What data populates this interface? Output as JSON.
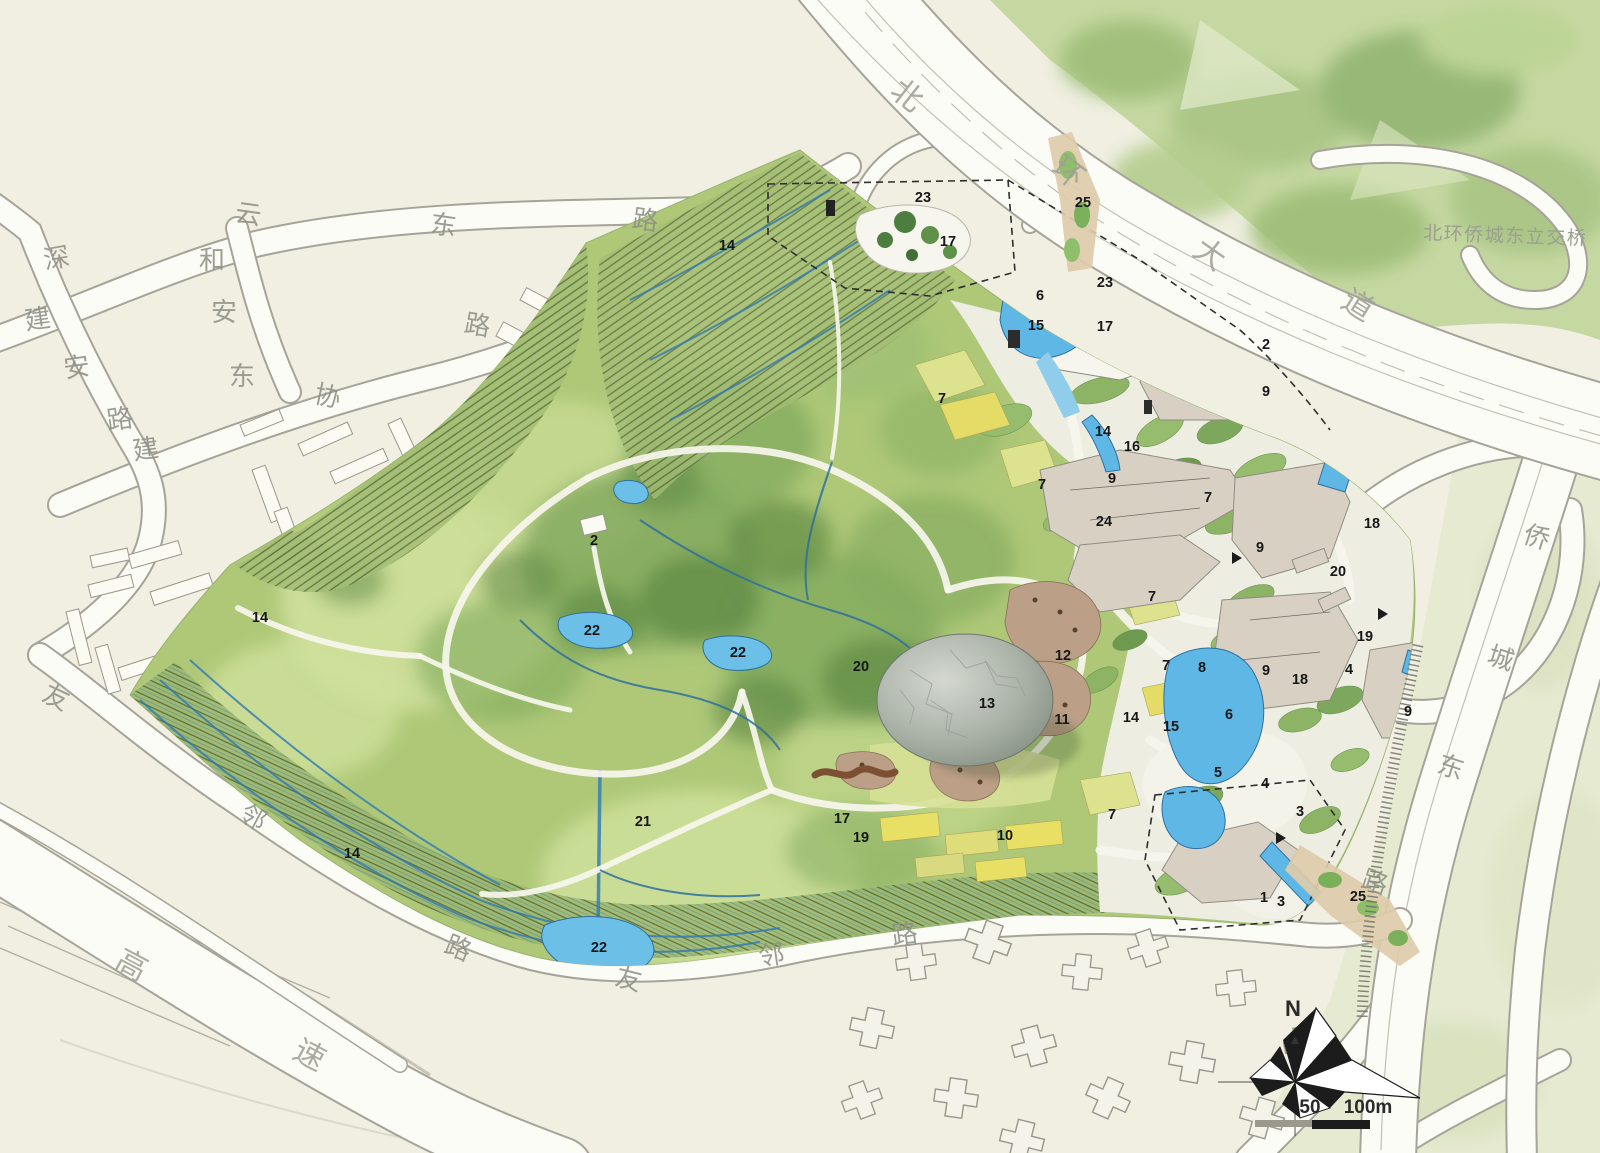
{
  "map": {
    "region_labels": [
      {
        "n": "14",
        "x": 727,
        "y": 246
      },
      {
        "n": "23",
        "x": 923,
        "y": 198
      },
      {
        "n": "17",
        "x": 948,
        "y": 242
      },
      {
        "n": "25",
        "x": 1083,
        "y": 203
      },
      {
        "n": "23",
        "x": 1105,
        "y": 283
      },
      {
        "n": "6",
        "x": 1040,
        "y": 296
      },
      {
        "n": "15",
        "x": 1036,
        "y": 326
      },
      {
        "n": "17",
        "x": 1105,
        "y": 327
      },
      {
        "n": "2",
        "x": 1266,
        "y": 345
      },
      {
        "n": "9",
        "x": 1266,
        "y": 392
      },
      {
        "n": "7",
        "x": 942,
        "y": 399
      },
      {
        "n": "14",
        "x": 1103,
        "y": 432
      },
      {
        "n": "16",
        "x": 1132,
        "y": 447
      },
      {
        "n": "9",
        "x": 1112,
        "y": 479
      },
      {
        "n": "7",
        "x": 1042,
        "y": 485
      },
      {
        "n": "7",
        "x": 1208,
        "y": 498
      },
      {
        "n": "24",
        "x": 1104,
        "y": 522
      },
      {
        "n": "2",
        "x": 594,
        "y": 541
      },
      {
        "n": "18",
        "x": 1372,
        "y": 524
      },
      {
        "n": "9",
        "x": 1260,
        "y": 548
      },
      {
        "n": "20",
        "x": 1338,
        "y": 572
      },
      {
        "n": "7",
        "x": 1152,
        "y": 597
      },
      {
        "n": "14",
        "x": 260,
        "y": 618
      },
      {
        "n": "22",
        "x": 592,
        "y": 631
      },
      {
        "n": "12",
        "x": 1063,
        "y": 656
      },
      {
        "n": "19",
        "x": 1365,
        "y": 637
      },
      {
        "n": "22",
        "x": 738,
        "y": 653
      },
      {
        "n": "20",
        "x": 861,
        "y": 667
      },
      {
        "n": "7",
        "x": 1166,
        "y": 666
      },
      {
        "n": "8",
        "x": 1202,
        "y": 668
      },
      {
        "n": "9",
        "x": 1266,
        "y": 671
      },
      {
        "n": "4",
        "x": 1349,
        "y": 670
      },
      {
        "n": "18",
        "x": 1300,
        "y": 680
      },
      {
        "n": "13",
        "x": 987,
        "y": 704
      },
      {
        "n": "11",
        "x": 1062,
        "y": 720
      },
      {
        "n": "14",
        "x": 1131,
        "y": 718
      },
      {
        "n": "15",
        "x": 1171,
        "y": 727
      },
      {
        "n": "6",
        "x": 1229,
        "y": 715
      },
      {
        "n": "9",
        "x": 1408,
        "y": 712
      },
      {
        "n": "5",
        "x": 1218,
        "y": 773
      },
      {
        "n": "4",
        "x": 1265,
        "y": 784
      },
      {
        "n": "7",
        "x": 1112,
        "y": 815
      },
      {
        "n": "3",
        "x": 1300,
        "y": 812
      },
      {
        "n": "21",
        "x": 643,
        "y": 822
      },
      {
        "n": "17",
        "x": 842,
        "y": 819
      },
      {
        "n": "19",
        "x": 861,
        "y": 838
      },
      {
        "n": "10",
        "x": 1005,
        "y": 836
      },
      {
        "n": "14",
        "x": 352,
        "y": 854
      },
      {
        "n": "1",
        "x": 1264,
        "y": 898
      },
      {
        "n": "3",
        "x": 1281,
        "y": 902
      },
      {
        "n": "25",
        "x": 1358,
        "y": 897
      },
      {
        "n": "22",
        "x": 599,
        "y": 948
      }
    ],
    "road_name_chars": [
      {
        "t": "深",
        "x": 57,
        "y": 261,
        "r": -10
      },
      {
        "t": "云",
        "x": 248,
        "y": 217,
        "r": 8
      },
      {
        "t": "东",
        "x": 443,
        "y": 228,
        "r": 8
      },
      {
        "t": "路",
        "x": 645,
        "y": 223,
        "r": 8
      },
      {
        "t": "和",
        "x": 212,
        "y": 263,
        "r": 0
      },
      {
        "t": "安",
        "x": 224,
        "y": 315,
        "r": 0
      },
      {
        "t": "东",
        "x": 242,
        "y": 379,
        "r": 0
      },
      {
        "t": "路",
        "x": 477,
        "y": 328,
        "r": 10
      },
      {
        "t": "建",
        "x": 38,
        "y": 322,
        "r": -8
      },
      {
        "t": "安",
        "x": 77,
        "y": 370,
        "r": -8
      },
      {
        "t": "路",
        "x": 120,
        "y": 422,
        "r": -8
      },
      {
        "t": "建",
        "x": 146,
        "y": 452,
        "r": -8
      },
      {
        "t": "协",
        "x": 327,
        "y": 399,
        "r": 12
      },
      {
        "t": "北",
        "x": 905,
        "y": 98,
        "r": 38,
        "big": true
      },
      {
        "t": "环",
        "x": 1066,
        "y": 175,
        "r": 38,
        "big": true
      },
      {
        "t": "大",
        "x": 1208,
        "y": 257,
        "r": 35,
        "big": true
      },
      {
        "t": "道",
        "x": 1356,
        "y": 308,
        "r": 32,
        "big": true
      },
      {
        "t": "友",
        "x": 55,
        "y": 700,
        "r": 25
      },
      {
        "t": "邻",
        "x": 252,
        "y": 820,
        "r": 28
      },
      {
        "t": "路",
        "x": 457,
        "y": 951,
        "r": 22
      },
      {
        "t": "友",
        "x": 628,
        "y": 982,
        "r": 14
      },
      {
        "t": "邻",
        "x": 772,
        "y": 958,
        "r": -8
      },
      {
        "t": "路",
        "x": 905,
        "y": 937,
        "r": -8
      },
      {
        "t": "高",
        "x": 130,
        "y": 968,
        "r": 28,
        "big": true
      },
      {
        "t": "速",
        "x": 308,
        "y": 1058,
        "r": 28,
        "big": true
      },
      {
        "t": "侨",
        "x": 1536,
        "y": 540,
        "r": 18
      },
      {
        "t": "城",
        "x": 1500,
        "y": 661,
        "r": 18
      },
      {
        "t": "东",
        "x": 1450,
        "y": 770,
        "r": 18
      },
      {
        "t": "路",
        "x": 1374,
        "y": 885,
        "r": 18
      }
    ],
    "bridge_label": {
      "text": "北环侨城东立交桥"
    },
    "compass": {
      "north_label": "N"
    },
    "scale_bar": {
      "first_tick": "50",
      "second_tick": "100m"
    }
  },
  "colors": {
    "paper": "#f0efe2",
    "road_fill": "#fcfcf7",
    "road_casing": "#a6a399",
    "park_green": "#aec878",
    "forest_green": "#c4d6a0",
    "water": "#62b5e5",
    "stream": "#2f6f9f",
    "building_beige": "#d8d1c3",
    "label_gray": "#8e9086",
    "boundary_black": "#2e2e2e"
  }
}
